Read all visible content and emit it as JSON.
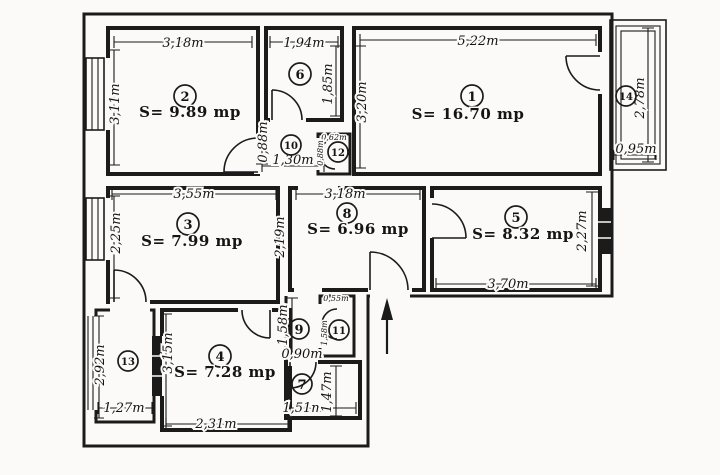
{
  "plan": {
    "type": "apartment-floor-plan",
    "area_unit": "mp",
    "colors": {
      "ink": "#1b1b1b",
      "paper": "#fbfaf8"
    },
    "compass": "north-arrow-up",
    "rooms": [
      {
        "id": "1",
        "label": "1",
        "area": "S= 16.70 mp",
        "dims": {
          "width": "5,22m",
          "height": "3,20m"
        }
      },
      {
        "id": "2",
        "label": "2",
        "area": "S= 9.89 mp",
        "dims": {
          "width": "3,18m",
          "height": "3,11m"
        }
      },
      {
        "id": "3",
        "label": "3",
        "area": "S= 7.99 mp",
        "dims": {
          "width": "3,55m",
          "height_left": "2,25m",
          "height_right": "2,19m"
        }
      },
      {
        "id": "4",
        "label": "4",
        "area": "S= 7.28 mp",
        "dims": {
          "width": "2,31m",
          "height": "3,15m"
        }
      },
      {
        "id": "5",
        "label": "5",
        "area": "S= 8.32 mp",
        "dims": {
          "width": "3,70m",
          "height": "2,27m"
        }
      },
      {
        "id": "6",
        "label": "6",
        "dims": {
          "width": "1,94m",
          "height": "1,85m"
        }
      },
      {
        "id": "7",
        "label": "7",
        "dims": {
          "width": "1,51m",
          "height": "1,47m",
          "top": "0,90m"
        }
      },
      {
        "id": "8",
        "label": "8",
        "area": "S= 6.96 mp",
        "dims": {
          "width": "3,18m"
        }
      },
      {
        "id": "9",
        "label": "9",
        "dims": {
          "height": "1,58m"
        }
      },
      {
        "id": "10",
        "label": "10",
        "dims": {
          "width": "1,30m",
          "height": "0,88m"
        }
      },
      {
        "id": "11",
        "label": "11",
        "dims": {
          "width": "0,55m",
          "height": "1,58m"
        }
      },
      {
        "id": "12",
        "label": "12",
        "dims": {
          "width": "0,62m",
          "height": "0,88m"
        }
      },
      {
        "id": "13",
        "label": "13",
        "dims": {
          "width": "1,27m",
          "height": "2,92m"
        }
      },
      {
        "id": "14",
        "label": "14",
        "dims": {
          "width": "0,95m",
          "height": "2,78m"
        }
      }
    ]
  }
}
